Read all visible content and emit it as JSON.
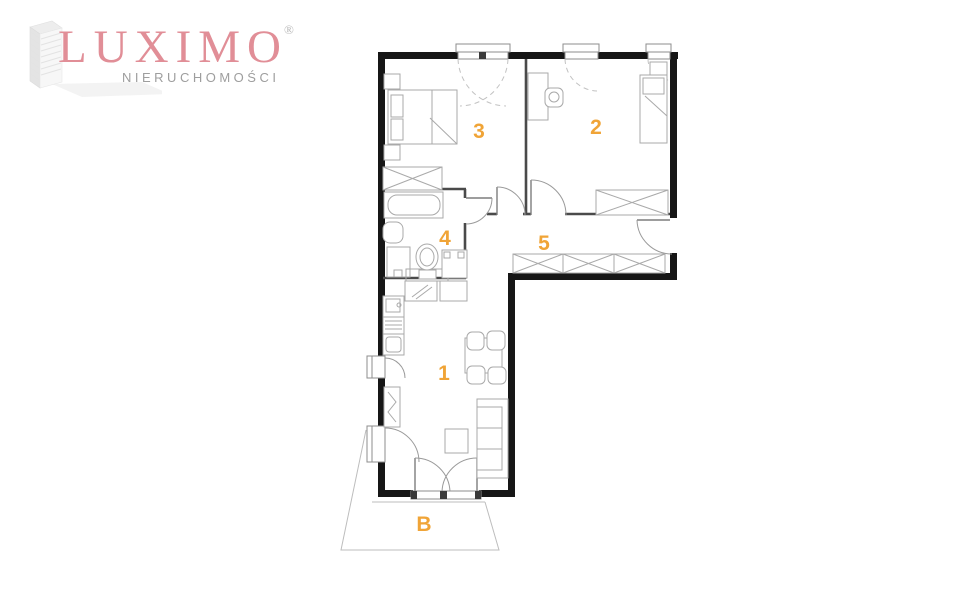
{
  "logo": {
    "brand": "LUXIMO",
    "registered_mark": "®",
    "subtitle": "NIERUCHOMOŚCI",
    "brand_color": "#e18e97",
    "subtitle_color": "#9e9e9e"
  },
  "floorplan": {
    "type": "apartment-floor-plan",
    "label_color": "#f0a437",
    "wall_color": "#161616",
    "rooms": {
      "living_kitchen": "1",
      "bedroom_right": "2",
      "bedroom_left": "3",
      "bathroom": "4",
      "hallway": "5",
      "balcony": "B"
    }
  }
}
